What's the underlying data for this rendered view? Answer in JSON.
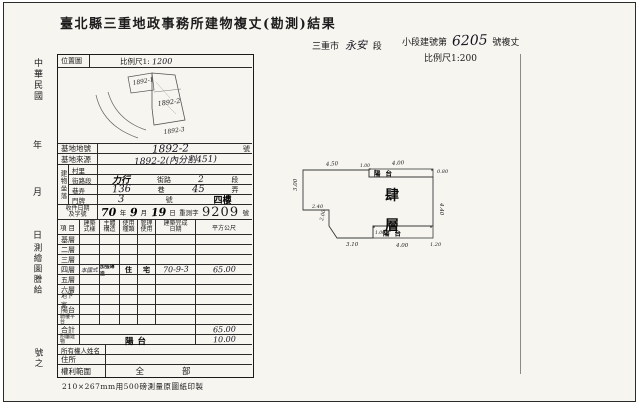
{
  "colors": {
    "ink": "#1c1c1c",
    "paper": "#f6f5f0",
    "frame": "#2b2b2b"
  },
  "title": "臺北縣三重地政事務所建物複丈(勘測)結果",
  "header_right": {
    "district_prefix": "三重市",
    "district_name": "永安",
    "district_suffix": "段",
    "building_prefix": "小段建號第",
    "building_number": "6205",
    "building_suffix": "號複丈",
    "scale": "比例尺1:200"
  },
  "margin_left": {
    "era": "中華民國",
    "year": "年",
    "month": "月",
    "day": "日",
    "issue": "測繪圖謄給",
    "number_suffix": "號之"
  },
  "location_map": {
    "label": "位置圖",
    "scale_prefix": "比例尺1:",
    "scale_value": "1200",
    "parcels": [
      {
        "id": "1892-1"
      },
      {
        "id": "1892-2"
      },
      {
        "id": "1892-3"
      }
    ]
  },
  "site": {
    "lot_label": "基地地號",
    "lot_value": "1892-2",
    "lot_unit": "號",
    "origin_label": "基地來源",
    "origin_value": "1892-2(內分割451)"
  },
  "address": {
    "group_label": "建物坐落",
    "village_label": "村里",
    "street_row_label": "街路段",
    "street_value": "力行",
    "street_unit": "街路",
    "section_value": "2",
    "section_unit": "段",
    "lane_row_label": "巷弄",
    "lane_value": "136",
    "lane_unit": "巷",
    "alley_value": "45",
    "alley_unit": "弄",
    "door_row_label": "門牌",
    "door_value": "3",
    "door_unit": "號",
    "floor_stamp": "四樓"
  },
  "receipt": {
    "label_line1": "收件日期",
    "label_line2": "及字號",
    "year_value": "70",
    "year_unit": "年",
    "month_value": "9",
    "month_unit": "月",
    "day_value": "19",
    "day_unit": "日",
    "word": "重測字",
    "number": "9209",
    "number_unit": "號"
  },
  "floor_table": {
    "headers": {
      "item": "項目",
      "style_l1": "建築",
      "style_l2": "式樣",
      "structure_l1": "主體",
      "structure_l2": "構造",
      "use_l1": "使用",
      "use_l2": "種類",
      "manage_l1": "管理",
      "manage_l2": "使用",
      "date_l1": "建築完成",
      "date_l2": "日期",
      "area": "平方公尺"
    },
    "rows": [
      {
        "label": "基層",
        "style": "",
        "structure": "",
        "use": "",
        "manage": "",
        "date": "",
        "area": ""
      },
      {
        "label": "二層",
        "style": "",
        "structure": "",
        "use": "",
        "manage": "",
        "date": "",
        "area": ""
      },
      {
        "label": "三層",
        "style": "",
        "structure": "",
        "use": "",
        "manage": "",
        "date": "",
        "area": ""
      },
      {
        "label": "四層",
        "style": "本國式",
        "structure": "加強磚造",
        "use": "住",
        "manage": "宅",
        "date": "70-9-3",
        "area": "65.00"
      },
      {
        "label": "五層",
        "style": "",
        "structure": "",
        "use": "",
        "manage": "",
        "date": "",
        "area": ""
      },
      {
        "label": "六層",
        "style": "",
        "structure": "",
        "use": "",
        "manage": "",
        "date": "",
        "area": ""
      },
      {
        "label": "地下室",
        "style": "",
        "structure": "",
        "use": "",
        "manage": "",
        "date": "",
        "area": ""
      },
      {
        "label": "陽台",
        "style": "",
        "structure": "",
        "use": "",
        "manage": "",
        "date": "",
        "area": ""
      },
      {
        "label": "騎樓平台",
        "style": "",
        "structure": "",
        "use": "",
        "manage": "",
        "date": "",
        "area": ""
      }
    ],
    "total_label": "合計",
    "total_area": "65.00",
    "annex_label": "附屬建物",
    "annex_stamp": "陽台",
    "annex_area": "10.00"
  },
  "owner": {
    "name_label": "所有權人姓名",
    "name_value": "",
    "address_label": "住所",
    "address_value": "",
    "rights_label": "權利範圍",
    "rights_value": "全部"
  },
  "footer_note": "210×267mm用500磅測量原圖紙印製",
  "floor_plan": {
    "floor_char1": "肆",
    "floor_char2": "層",
    "balcony_top": "陽台",
    "balcony_bottom": "陽台",
    "dims": {
      "top_left": "4.50",
      "top_balcony": "4.00",
      "balcony_left_small": "1.00",
      "right_top_small": "0.80",
      "right_edge": "4.40",
      "left_edge": "3.00",
      "step_h": "2.40",
      "step_v": "2.00",
      "bottom_left": "3.10",
      "bottom_balcony": "4.00",
      "bottom_right_small": "1.20",
      "notch_small": "1.00"
    }
  }
}
